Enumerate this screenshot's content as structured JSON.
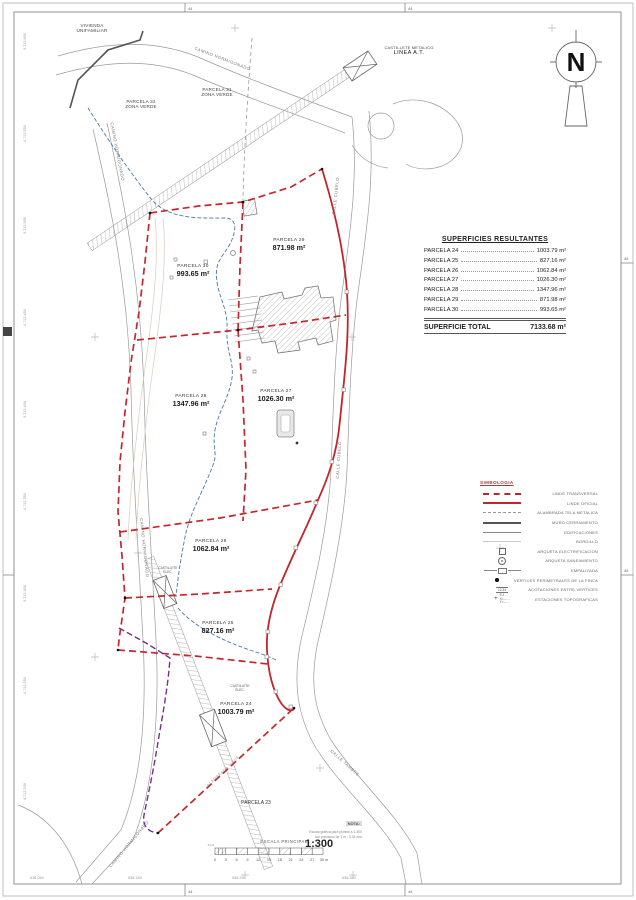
{
  "sheet": {
    "north_letter": "N",
    "frame_marks": {
      "top_left": "44",
      "top_right": "44",
      "bottom_left": "44",
      "bottom_right": "44",
      "right_upper": "45",
      "right_lower": "45"
    },
    "margin_left_labels": [
      "4.712.600",
      "4.712.550",
      "4.712.500",
      "4.712.450",
      "4.712.400",
      "4.712.350",
      "4.712.300",
      "4.712.250",
      "4.712.200"
    ],
    "margin_bottom_labels": [
      "536.050",
      "536.150",
      "536.250",
      "536.350"
    ]
  },
  "map": {
    "labels": {
      "vivienda": {
        "line1": "VIVIENDA",
        "line2": "UNIFAMILIAR"
      },
      "castillete_at": {
        "line1": "CASTILLETE METALICO",
        "line2": "LINEA A.T."
      },
      "parcela31": {
        "line1": "PARCELA 31",
        "line2": "ZONA VERDE"
      },
      "parcela32": {
        "line1": "PARCELA 32",
        "line2": "ZONA VERDE"
      },
      "parcela23": "PARCELA 23",
      "alambrada_linde": "ALAMBRADA LINDE",
      "castillete_elec_upper": {
        "line1": "CASTILLETE",
        "line2": "ELEC."
      },
      "castillete_elec_lower": {
        "line1": "CASTILLETE",
        "line2": "ELEC."
      }
    },
    "streets": {
      "camino_top": "CAMINO HORMIGONADO",
      "camino_left": "CAMINO HORMIGONADO",
      "camino_mid": "CAMINO HORMIGONADO",
      "camino_bottom": "CAMINO HORMIGONADO",
      "calle_cubelo_upper": "CALLE CUBELO",
      "calle_cubelo_lower": "CALLE CUBELO",
      "calle_tambre": "CALLE TAMBRE"
    },
    "parcels": [
      {
        "name": "PARCELA 30",
        "area": "993.65 m²"
      },
      {
        "name": "PARCELA 29",
        "area": "871.98 m²"
      },
      {
        "name": "PARCELA 28",
        "area": "1347.96 m²"
      },
      {
        "name": "PARCELA 27",
        "area": "1026.30 m²"
      },
      {
        "name": "PARCELA 26",
        "area": "1062.84 m²"
      },
      {
        "name": "PARCELA 25",
        "area": "827.16 m²"
      },
      {
        "name": "PARCELA 24",
        "area": "1003.79 m²"
      }
    ]
  },
  "table": {
    "title": "SUPERFICIES RESULTANTES",
    "rows": [
      {
        "label": "PARCELA 24",
        "value": "1003.79 m²"
      },
      {
        "label": "PARCELA 25",
        "value": "827.16 m²"
      },
      {
        "label": "PARCELA 26",
        "value": "1062.84 m²"
      },
      {
        "label": "PARCELA 27",
        "value": "1026.30 m²"
      },
      {
        "label": "PARCELA 28",
        "value": "1347.96 m²"
      },
      {
        "label": "PARCELA 29",
        "value": "871.98 m²"
      },
      {
        "label": "PARCELA 30",
        "value": "993.65 m²"
      }
    ],
    "total_label": "SUPERFICIE TOTAL",
    "total_value": "7133.68 m²"
  },
  "legend": {
    "title": "SIMBOLOGIA",
    "items": [
      {
        "label": "LINDE TRANSVERSAL"
      },
      {
        "label": "LINDE OFICIAL"
      },
      {
        "label": "ALAMBRADA TELA METALICA"
      },
      {
        "label": "MURO CERRAMIENTO"
      },
      {
        "label": "EDIFICACIONES"
      },
      {
        "label": "BORDILLO"
      },
      {
        "label": "ARQUETA ELECTRIFICACION"
      },
      {
        "label": "ARQUETA SANEAMIENTO"
      },
      {
        "label": "EMPALIZADA"
      },
      {
        "label": "VERTICES PERIMETRALES DE LA FINCA"
      },
      {
        "label": "ACOTACIONES ENTRE VERTICES"
      },
      {
        "label": "ESTACIONES TOPOGRAFICAS"
      }
    ],
    "station_tag": "E-1",
    "station_x": "X=",
    "station_y": "Y=",
    "acot_sample": "12.34"
  },
  "scale": {
    "caption": "ESCALA PRINCIPAL",
    "ratio": "1:300",
    "ticks": [
      "0",
      "3",
      "6",
      "9",
      "12",
      "15",
      "18",
      "21",
      "24",
      "27",
      "30 m"
    ],
    "sub_left": "1m 0"
  },
  "nota": {
    "title": "NOTA:",
    "line1": "Escala gráfica para plotear a 1:300",
    "line2": "con precisión de 1 m : 3.33 mm"
  },
  "colors": {
    "linde_red": "#c0272d",
    "stream_blue": "#4878a8",
    "utility_purple": "#7b2d8b",
    "road_gray": "#9a9a9a"
  }
}
